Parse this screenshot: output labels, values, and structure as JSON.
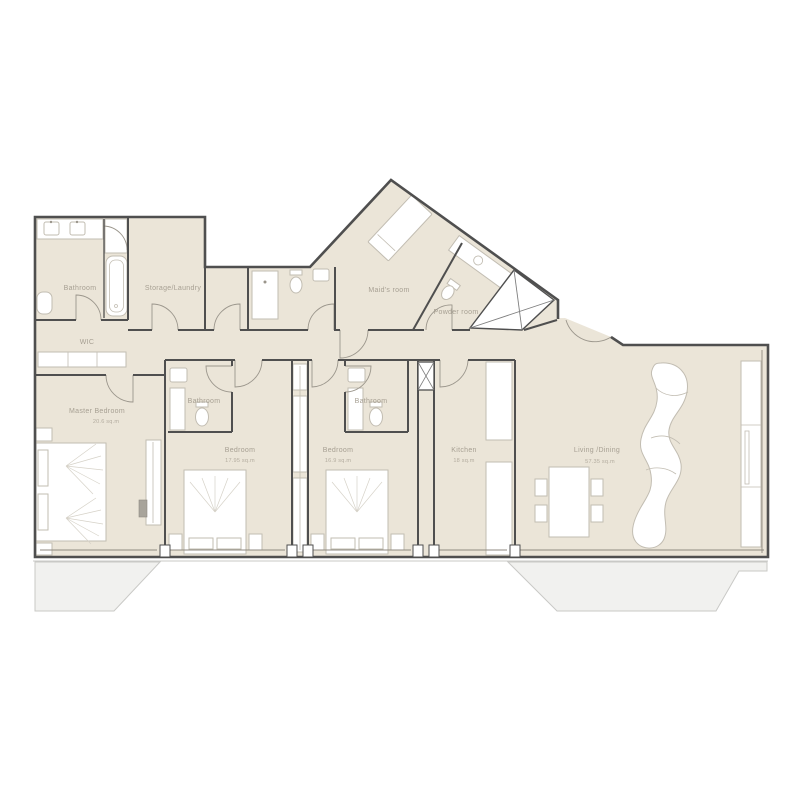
{
  "plan": {
    "type": "apartment-floor-plan",
    "colors": {
      "wall": "#4f4f4f",
      "floor": "#ebe5d8",
      "fixture_outline": "#c2bdb2",
      "label_text": "#a7a093",
      "terrace_fill": "#f1f1ef",
      "terrace_stroke": "#c9c9c6"
    },
    "rooms": {
      "bathroom_main": {
        "label": "Bathroom"
      },
      "storage_laundry": {
        "label": "Storage/Laundry"
      },
      "maids_room": {
        "label": "Maid's room"
      },
      "powder_room": {
        "label": "Powder room"
      },
      "wic": {
        "label": "WIC"
      },
      "master_bedroom": {
        "label": "Master Bedroom",
        "area": "20.6 sq.m"
      },
      "bathroom_1": {
        "label": "Bathroom"
      },
      "bathroom_2": {
        "label": "Bathroom"
      },
      "bedroom_1": {
        "label": "Bedroom",
        "area": "17.95 sq.m"
      },
      "bedroom_2": {
        "label": "Bedroom",
        "area": "16.9 sq.m"
      },
      "kitchen": {
        "label": "Kitchen",
        "area": "18 sq.m"
      },
      "living_dining": {
        "label": "Living /Dining",
        "area": "57.35 sq.m"
      }
    }
  }
}
